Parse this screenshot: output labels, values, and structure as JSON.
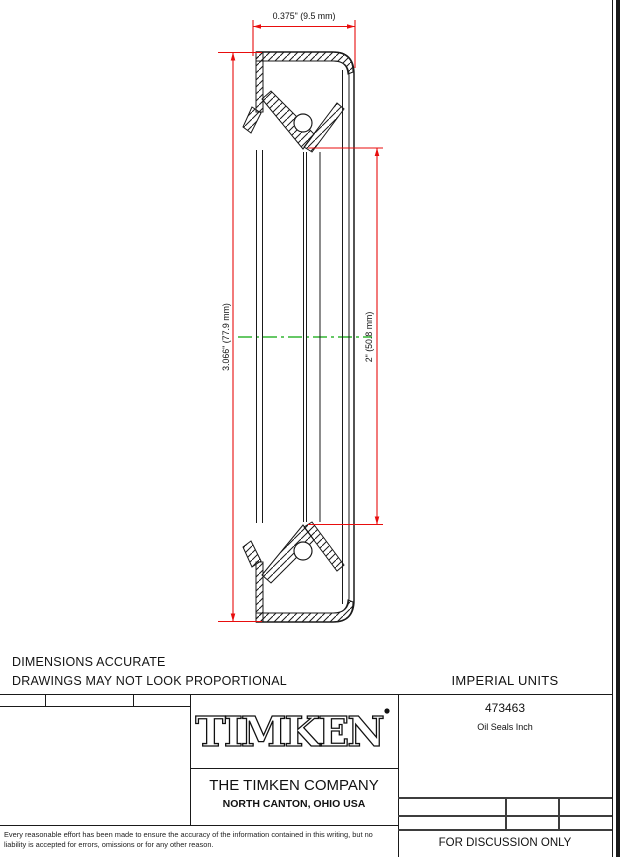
{
  "drawing": {
    "dim_width": "0.375\" (9.5 mm)",
    "dim_outer_diameter": "3.066\" (77.9 mm)",
    "dim_inner_diameter": "2\" (50.8 mm)"
  },
  "notes": {
    "line1": "DIMENSIONS ACCURATE",
    "line2": "DRAWINGS MAY NOT LOOK PROPORTIONAL"
  },
  "title_block": {
    "units_label": "IMPERIAL UNITS",
    "part_number": "473463",
    "part_type": "Oil Seals Inch",
    "logo_text": "TIMKEN",
    "company_name": "THE TIMKEN COMPANY",
    "company_location": "NORTH CANTON, OHIO USA",
    "status": "FOR DISCUSSION ONLY",
    "disclaimer": "Every reasonable effort has been made to ensure the accuracy of the information contained in this writing, but no liability is accepted for errors, omissions or for any other reason."
  },
  "colors": {
    "dimension_red": "#e80d0d",
    "centerline_green": "#33b533",
    "drawing_black": "#1a1a1a"
  }
}
